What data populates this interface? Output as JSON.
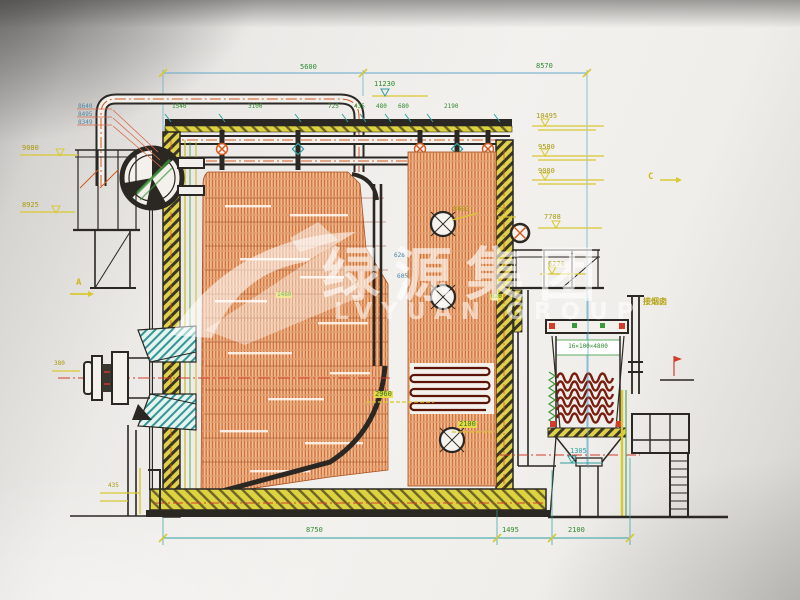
{
  "watermark": {
    "cn": "绿源集团",
    "en": "LVYUAN GROUP"
  },
  "markers": {
    "a": "A",
    "c": "C"
  },
  "dims_top": {
    "d5600": "5600",
    "d8570": "8570",
    "d11230": "11230"
  },
  "dims_row": [
    "1540",
    "3100",
    "725",
    "435",
    "480",
    "680",
    "2190"
  ],
  "elev_left": {
    "e1": "8640",
    "e2": "8495",
    "e3": "8349",
    "l9080": "9080",
    "l8925": "8925",
    "l380": "380",
    "l435": "435"
  },
  "elev_right": {
    "l10495": "10495",
    "l9580": "9580",
    "l9080": "9080",
    "l8603": "8603",
    "l770": "770",
    "l7708": "7708",
    "l6270": "6270"
  },
  "dims_mid": {
    "l2960": "2960",
    "l2100": "2100",
    "l1305": "1305",
    "l628": "628",
    "l605": "605",
    "l1480": "1480",
    "l620": "620"
  },
  "dims_bottom": [
    "8750",
    "1495",
    "2100"
  ],
  "economizer": {
    "spec": "16×100×4800",
    "chimney_label": "接烟囱"
  }
}
